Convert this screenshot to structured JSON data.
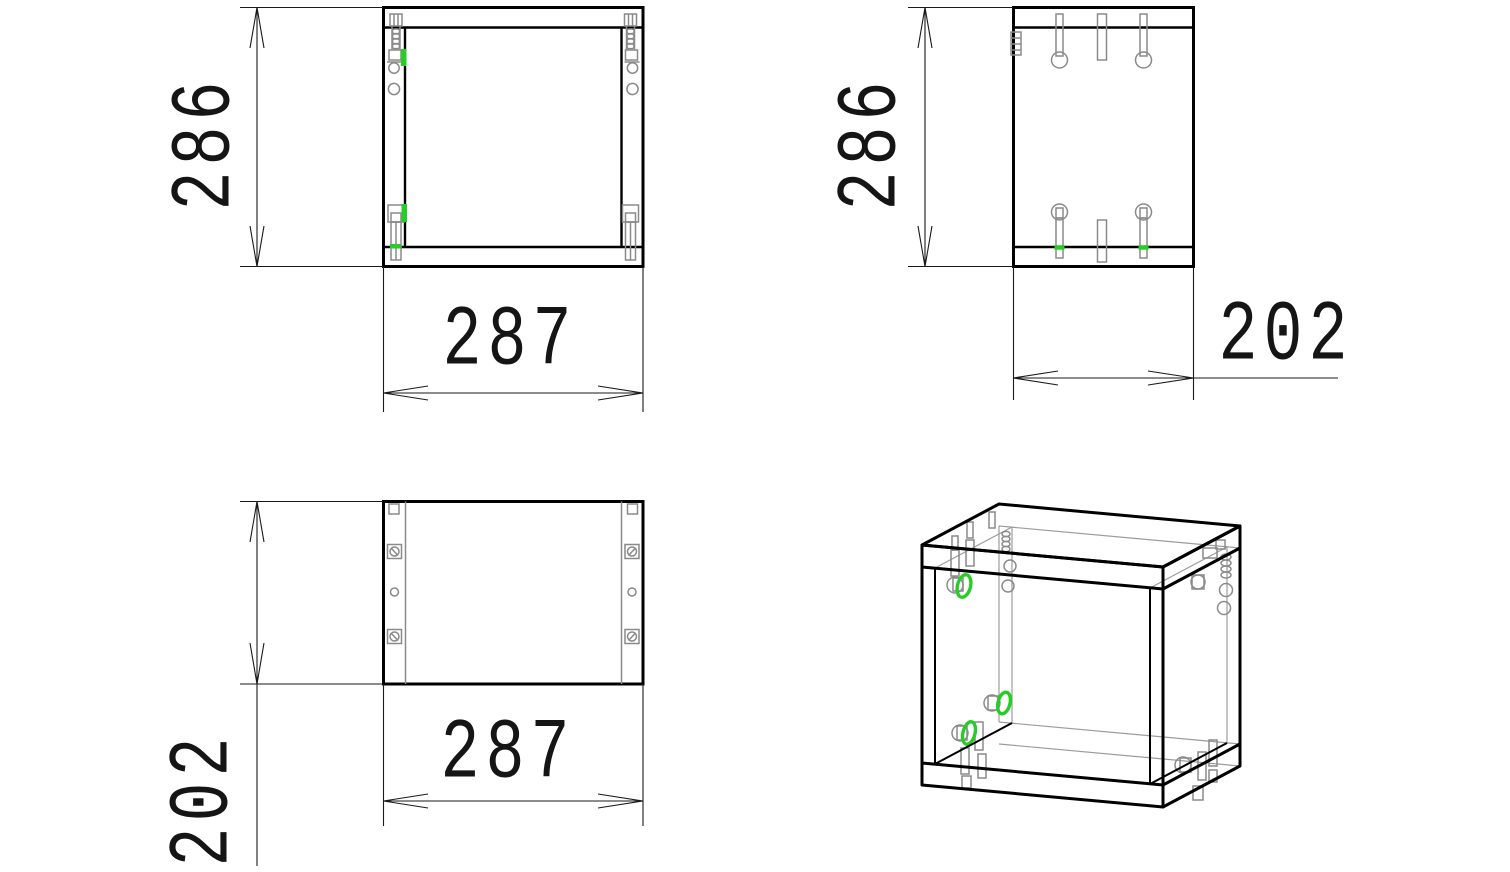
{
  "drawing": {
    "kind": "furniture-cabinet-assembly-drawing",
    "views": {
      "front": {
        "height_label": "286",
        "width_label": "287"
      },
      "side": {
        "height_label": "286",
        "depth_label": "202"
      },
      "top": {
        "depth_label": "202",
        "width_label": "287"
      },
      "isometric": {
        "highlight_count": 3
      }
    },
    "dimensions_mm": {
      "width": 287,
      "height": 286,
      "depth": 202
    },
    "colors": {
      "line": "#000000",
      "hardware": "#8a8a8a",
      "highlight": "#25cd25",
      "background": "#ffffff",
      "text": "#151515"
    }
  }
}
